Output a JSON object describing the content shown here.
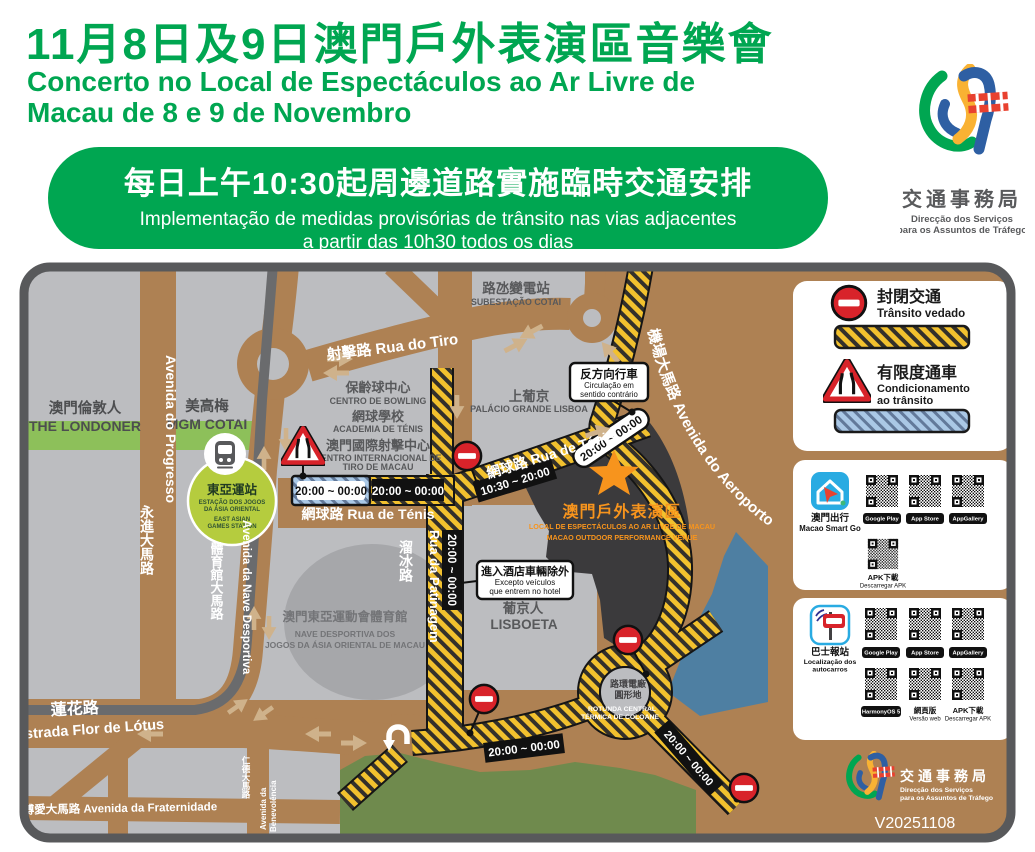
{
  "header": {
    "title_zh": "11月8日及9日澳門戶外表演區音樂會",
    "title_pt1": "Concerto no Local de Espectáculos ao Ar Livre de",
    "title_pt2": "Macau de 8 e 9 de Novembro",
    "banner": {
      "zh": "每日上午10:30起周邊道路實施臨時交通安排",
      "pt1": "Implementação de medidas provisórias de trânsito nas vias adjacentes",
      "pt2": "a partir das 10h30 todos os dias"
    },
    "logo": {
      "zh": "交通事務局",
      "pt1": "Direcção dos Serviços",
      "pt2": "para os Assuntos de Tráfego"
    }
  },
  "map": {
    "version": "V20251108",
    "roads": {
      "tiro": "射擊路 Rua do Tiro",
      "tenis": "網球路 Rua de Ténis",
      "progresso_zh": "永進大馬路",
      "progresso_pt": "Avenida do Progresso",
      "nave_zh": "體育館大馬路",
      "nave_pt": "Avenida da Nave Desportiva",
      "patinagem_zh": "溜冰路",
      "patinagem_pt": "Rua da Patinagem",
      "aeroporto": "機場大馬路 Avenida do Aeroporto",
      "lotus_zh": "蓮花路",
      "lotus_pt": "Estrada Flor de Lótus",
      "fraternidade": "博愛大馬路 Avenida da Fraternidade",
      "benevolencia_zh": "仁德大馬路",
      "benevolencia_pt1": "Avenida da",
      "benevolencia_pt2": "Benevolência"
    },
    "places": {
      "substation_zh": "路氹變電站",
      "substation_pt": "SUBESTAÇÃO COTAI",
      "bowling_zh": "保齡球中心",
      "bowling_pt": "CENTRO DE BOWLING",
      "tennis_academy_zh": "網球學校",
      "tennis_academy_pt": "ACADEMIA DE TÉNIS",
      "shooting_zh": "澳門國際射擊中心",
      "shooting_pt1": "CENTRO INTERNACIONAL DE",
      "shooting_pt2": "TIRO DE MACAU",
      "grand_lisboa_zh": "上葡京",
      "grand_lisboa_pt": "PALÁCIO GRANDE LISBOA",
      "londoner_zh": "澳門倫敦人",
      "londoner_pt": "THE LONDONER",
      "mgm_zh": "美高梅",
      "mgm_pt": "MGM COTAI",
      "stadium_zh": "澳門東亞運動會體育館",
      "stadium_pt1": "NAVE DESPORTIVA DOS",
      "stadium_pt2": "JOGOS DA ÁSIA ORIENTAL DE MACAU",
      "lisboeta_zh": "葡京人",
      "lisboeta_pt": "LISBOETA",
      "venue_zh": "澳門戶外表演區",
      "venue_pt": "LOCAL DE ESPECTÁCULOS AO AR LIVRE DE MACAU",
      "venue_en": "MACAO OUTDOOR PERFORMANCE VENUE",
      "rotunda_zh1": "路環電廠",
      "rotunda_zh2": "圓形地",
      "rotunda_pt1": "ROTUNDA CENTRAL",
      "rotunda_pt2": "TÉRMICA DE COLOANE"
    },
    "station": {
      "zh": "東亞運站",
      "pt1": "ESTAÇÃO DOS JOGOS",
      "pt2": "DA ÁSIA ORIENTAL",
      "en1": "EAST ASIAN",
      "en2": "GAMES STATION"
    },
    "callouts": {
      "contraflow_zh": "反方向行車",
      "contraflow_pt1": "Circulação em",
      "contraflow_pt2": "sentido contrário",
      "hotel_zh": "進入酒店車輛除外",
      "hotel_pt1": "Excepto veículos",
      "hotel_pt2": "que entrem no hotel"
    },
    "times": {
      "t1": "20:00 ~ 00:00",
      "t2": "10:30 ~ 20:00"
    }
  },
  "legend": {
    "closed_zh": "封閉交通",
    "closed_pt": "Trânsito vedado",
    "cond_zh": "有限度通車",
    "cond_pt1": "Condicionamento",
    "cond_pt2": "ao trânsito"
  },
  "apps": {
    "badges": {
      "gp": "Google Play",
      "as": "App Store",
      "ag": "AppGallery"
    },
    "apk_zh": "APK下載",
    "apk_pt": "Descarregar APK",
    "smartgo": {
      "zh": "澳門出行",
      "en": "Macao Smart Go"
    },
    "bus": {
      "zh": "巴士報站",
      "pt1": "Localização dos",
      "pt2": "autocarros",
      "harmony": "HarmonyOS 5",
      "web_zh": "網頁版",
      "web_pt": "Versão web"
    }
  },
  "colors": {
    "brand_green": "#00a651",
    "road_brown": "#ae8153",
    "block_gray": "#bcbdc0",
    "closed_yellow": "#f2c12e",
    "conditioned_blue": "#aac8e6",
    "alert_red": "#d8232a",
    "venue_orange": "#f7941d",
    "water_blue": "#4e7fa2",
    "park_green": "#6f8a4d",
    "strip_green": "#8dc05a",
    "station_green": "#b5cc3e",
    "frame_gray": "#58595b"
  }
}
